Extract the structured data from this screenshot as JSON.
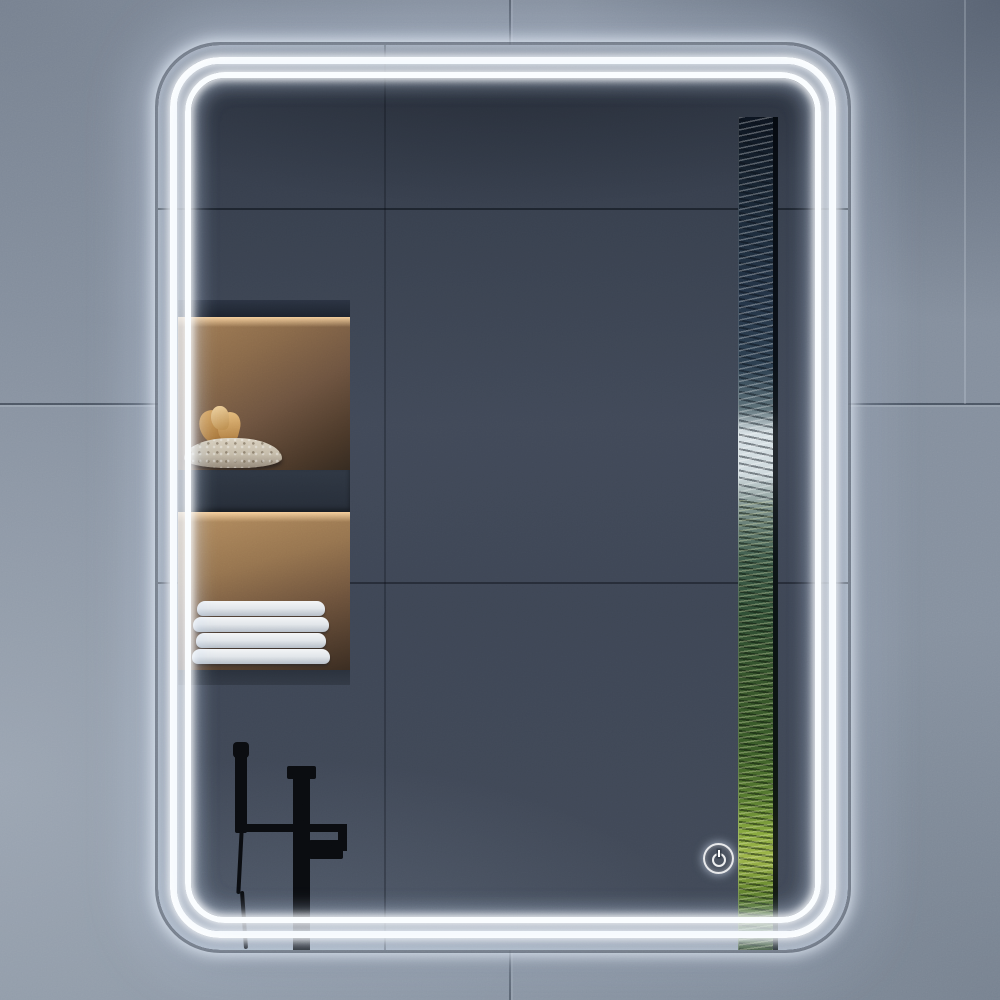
{
  "scene": {
    "type": "product-photo",
    "subject": "Rectangular LED bathroom mirror with rounded corners and double front-lit light strips",
    "environment": {
      "wall": {
        "material": "large gray concrete-look tiles",
        "base_color": "#8791a0",
        "grout_color": "#2f3946",
        "lighting": "soft ambient, darker toward upper-right corner"
      }
    },
    "mirror": {
      "shape": "portrait rounded rectangle",
      "led_strips": {
        "count": 2,
        "arrangement": "two concentric rounded-rectangle light lines near the edge",
        "color": "#ffffff",
        "glow_color": "#d5e5fb",
        "state": "on"
      },
      "halo_glow_on_wall": true
    },
    "reflection": {
      "wall": {
        "material": "dark slate tiles",
        "color": "#3e4654"
      },
      "niches": [
        {
          "label": "upper shelf niche",
          "lighting": "warm amber under-shelf light",
          "items": [
            "textured decorative bowl",
            "dried amber plant"
          ]
        },
        {
          "label": "lower shelf niche",
          "lighting": "warm amber under-shelf light",
          "items": [
            "stack of folded white towels"
          ],
          "towel_count": 4
        }
      ],
      "fixture": {
        "label": "freestanding bathtub faucet",
        "finish": "matte black",
        "parts": [
          "riser pole with cap",
          "mixer spout",
          "hand shower wand",
          "flexible hose"
        ]
      },
      "window": {
        "label": "narrow vertical window reflection",
        "view": "forest: dark conifers, bright sky patch, green and yellow-green foliage",
        "colors": [
          "#0c1420",
          "#d8e2e6",
          "#3d5a4a",
          "#87a83e",
          "#27401c"
        ]
      }
    },
    "controls": {
      "power_touch_button": {
        "icon": "power-icon",
        "symbol_description": "standby power symbol inside illuminated ring",
        "color": "#ffffff",
        "state": "illuminated"
      }
    },
    "palette": {
      "wall_gray": "#8791a0",
      "reflection_slate": "#3e4654",
      "niche_warm_brown": "#96744f",
      "led_white": "#ffffff",
      "foliage_green": "#587c30",
      "faucet_black": "#0a0c10",
      "towel_white": "#e9ecef"
    }
  }
}
